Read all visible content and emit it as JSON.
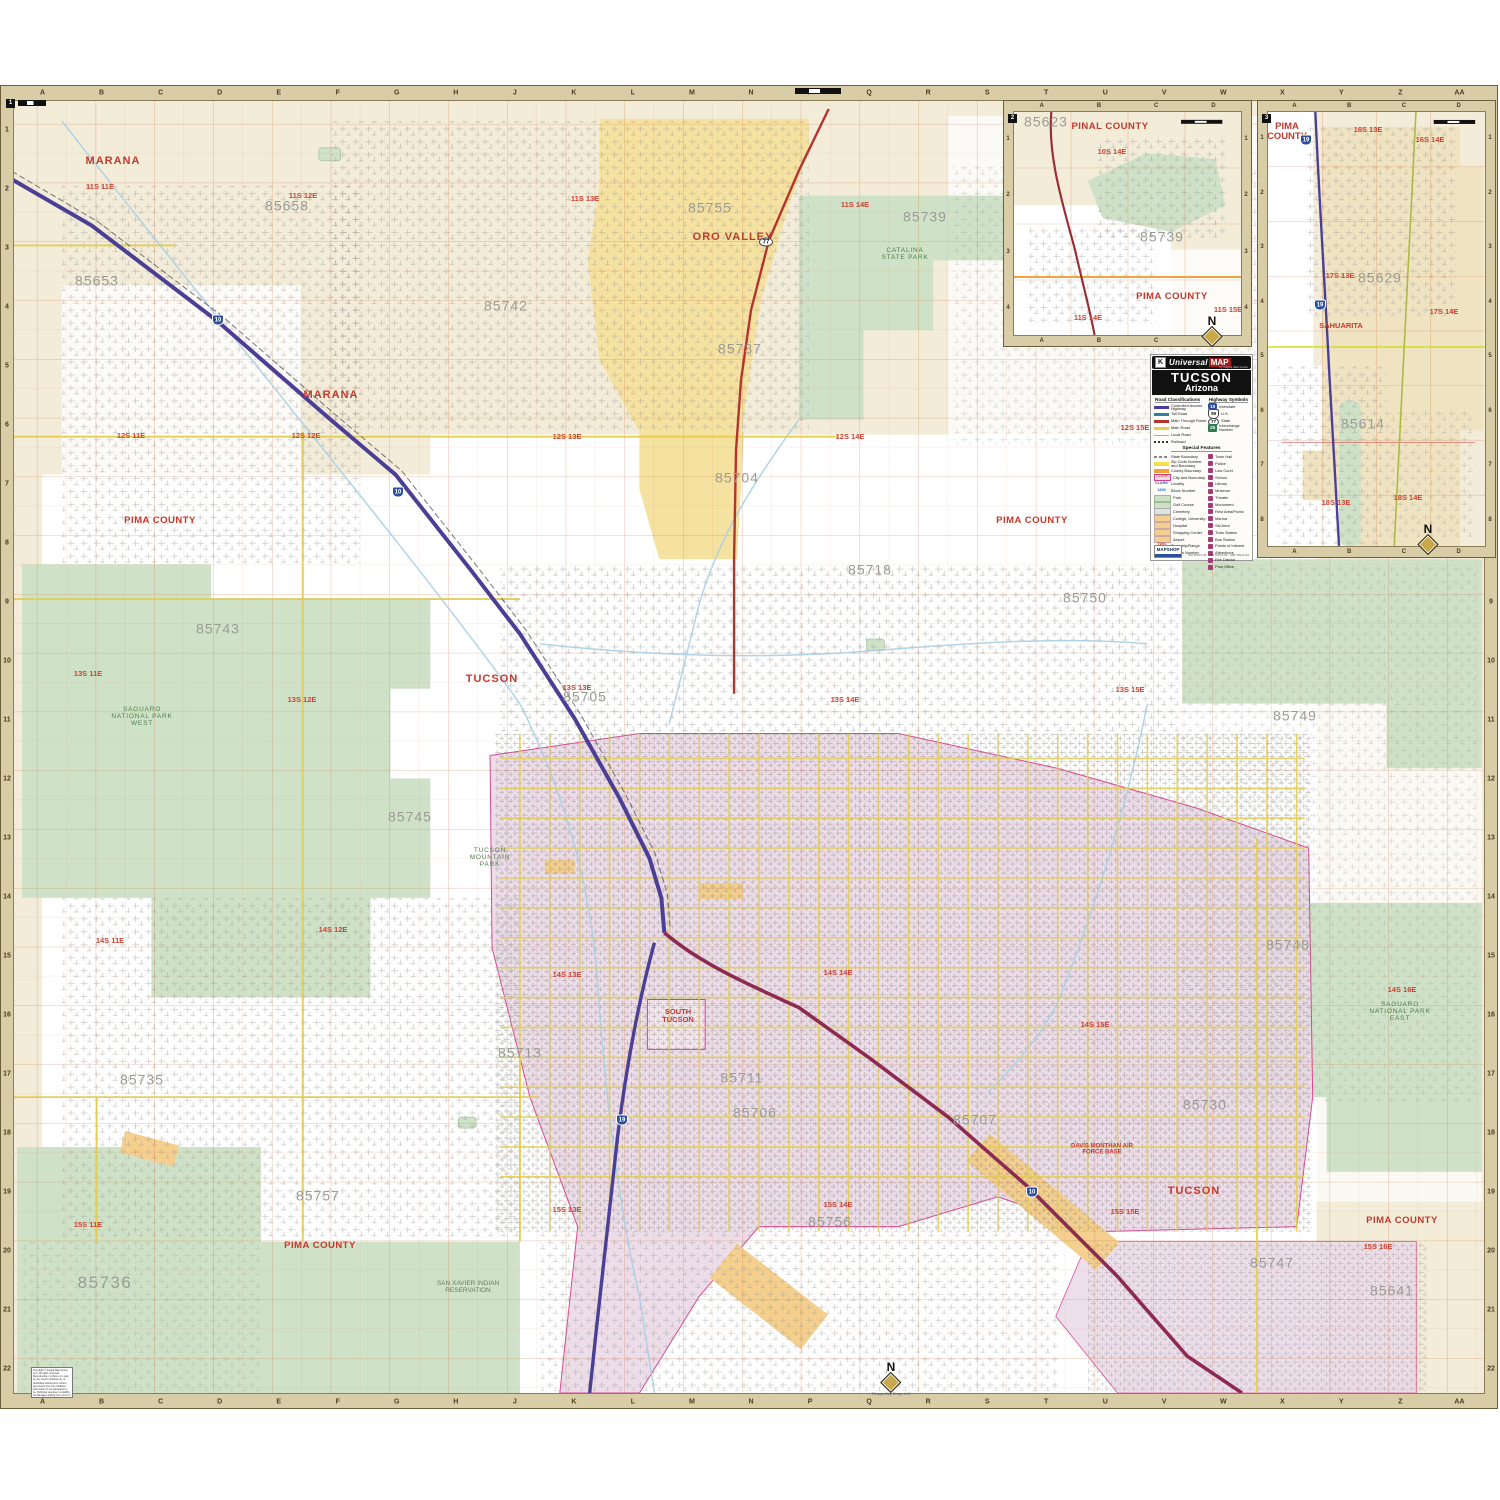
{
  "palette": {
    "cream": "#f2ecd9",
    "green": "#cfe2c8",
    "yellow_area": "#f5e1a0",
    "pink": "#ecdce8",
    "peach": "#f4cf8e",
    "border_tan": "#d8cda6",
    "grid_red": "#c65d2d",
    "road_yellow": "#e3cc52",
    "interstate": "#4a3f94",
    "main_route": "#b5332d",
    "water": "#a9cfe6",
    "label_red": "#c3392c",
    "label_gray": "#9b9b96"
  },
  "sheet": {
    "ref": "1"
  },
  "grid": {
    "columns": [
      "A",
      "B",
      "C",
      "D",
      "E",
      "F",
      "G",
      "H",
      "J",
      "K",
      "L",
      "M",
      "N",
      "P",
      "Q",
      "R",
      "S",
      "T",
      "U",
      "V",
      "W",
      "X",
      "Y",
      "Z",
      "AA"
    ],
    "rows": [
      "1",
      "2",
      "3",
      "4",
      "5",
      "6",
      "7",
      "8",
      "9",
      "10",
      "11",
      "12",
      "13",
      "14",
      "15",
      "16",
      "17",
      "18",
      "19",
      "20",
      "21",
      "22"
    ]
  },
  "map_labels": [
    {
      "t": "MARANA",
      "k": "city",
      "x": 113,
      "y": 162
    },
    {
      "t": "ORO VALLEY",
      "k": "city",
      "x": 733,
      "y": 238
    },
    {
      "t": "MARANA",
      "k": "city",
      "x": 331,
      "y": 396
    },
    {
      "t": "TUCSON",
      "k": "city",
      "x": 492,
      "y": 680
    },
    {
      "t": "TUCSON",
      "k": "city",
      "x": 1194,
      "y": 1192
    },
    {
      "t": "SOUTH TUCSON",
      "k": "citysm",
      "x": 678,
      "y": 1016,
      "w": 46
    },
    {
      "t": "PIMA COUNTY",
      "k": "county",
      "x": 160,
      "y": 521
    },
    {
      "t": "PIMA COUNTY",
      "k": "county",
      "x": 1032,
      "y": 521
    },
    {
      "t": "PIMA COUNTY",
      "k": "county",
      "x": 320,
      "y": 1246
    },
    {
      "t": "PIMA COUNTY",
      "k": "county",
      "x": 1402,
      "y": 1221
    },
    {
      "t": "11S 11E",
      "k": "twp",
      "x": 100,
      "y": 187
    },
    {
      "t": "11S 12E",
      "k": "twp",
      "x": 303,
      "y": 196
    },
    {
      "t": "11S 13E",
      "k": "twp",
      "x": 585,
      "y": 199
    },
    {
      "t": "11S 14E",
      "k": "twp",
      "x": 855,
      "y": 205
    },
    {
      "t": "12S 11E",
      "k": "twp",
      "x": 131,
      "y": 436
    },
    {
      "t": "12S 12E",
      "k": "twp",
      "x": 306,
      "y": 436
    },
    {
      "t": "12S 13E",
      "k": "twp",
      "x": 567,
      "y": 437
    },
    {
      "t": "12S 14E",
      "k": "twp",
      "x": 850,
      "y": 437
    },
    {
      "t": "12S 15E",
      "k": "twp",
      "x": 1135,
      "y": 428
    },
    {
      "t": "13S 11E",
      "k": "twp",
      "x": 88,
      "y": 674
    },
    {
      "t": "13S 12E",
      "k": "twp",
      "x": 302,
      "y": 700
    },
    {
      "t": "13S 13E",
      "k": "twp",
      "x": 577,
      "y": 688
    },
    {
      "t": "13S 14E",
      "k": "twp",
      "x": 845,
      "y": 700
    },
    {
      "t": "13S 15E",
      "k": "twp",
      "x": 1130,
      "y": 690
    },
    {
      "t": "14S 11E",
      "k": "twp",
      "x": 110,
      "y": 941
    },
    {
      "t": "14S 12E",
      "k": "twp",
      "x": 333,
      "y": 930
    },
    {
      "t": "14S 13E",
      "k": "twp",
      "x": 567,
      "y": 975
    },
    {
      "t": "14S 14E",
      "k": "twp",
      "x": 838,
      "y": 973
    },
    {
      "t": "14S 15E",
      "k": "twp",
      "x": 1095,
      "y": 1025
    },
    {
      "t": "14S 16E",
      "k": "twp",
      "x": 1402,
      "y": 990
    },
    {
      "t": "15S 11E",
      "k": "twp",
      "x": 88,
      "y": 1225
    },
    {
      "t": "15S 13E",
      "k": "twp",
      "x": 567,
      "y": 1210
    },
    {
      "t": "15S 14E",
      "k": "twp",
      "x": 838,
      "y": 1205
    },
    {
      "t": "15S 15E",
      "k": "twp",
      "x": 1125,
      "y": 1212
    },
    {
      "t": "15S 16E",
      "k": "twp",
      "x": 1378,
      "y": 1247
    },
    {
      "t": "85658",
      "k": "zip",
      "x": 287,
      "y": 206
    },
    {
      "t": "85653",
      "k": "zip",
      "x": 97,
      "y": 281
    },
    {
      "t": "85755",
      "k": "zip",
      "x": 710,
      "y": 208
    },
    {
      "t": "85739",
      "k": "zip",
      "x": 925,
      "y": 217
    },
    {
      "t": "85742",
      "k": "zip",
      "x": 506,
      "y": 306
    },
    {
      "t": "85737",
      "k": "zip",
      "x": 740,
      "y": 349
    },
    {
      "t": "85704",
      "k": "zip",
      "x": 737,
      "y": 478
    },
    {
      "t": "85718",
      "k": "zip",
      "x": 870,
      "y": 570
    },
    {
      "t": "85750",
      "k": "zip",
      "x": 1085,
      "y": 598
    },
    {
      "t": "85743",
      "k": "zip",
      "x": 218,
      "y": 629
    },
    {
      "t": "85705",
      "k": "zip",
      "x": 585,
      "y": 697
    },
    {
      "t": "85749",
      "k": "zip",
      "x": 1295,
      "y": 716
    },
    {
      "t": "85745",
      "k": "zip",
      "x": 410,
      "y": 817
    },
    {
      "t": "85748",
      "k": "zip",
      "x": 1288,
      "y": 945
    },
    {
      "t": "85735",
      "k": "zip",
      "x": 142,
      "y": 1080
    },
    {
      "t": "85713",
      "k": "zip",
      "x": 520,
      "y": 1053
    },
    {
      "t": "85711",
      "k": "zip",
      "x": 742,
      "y": 1078
    },
    {
      "t": "85730",
      "k": "zip",
      "x": 1205,
      "y": 1105
    },
    {
      "t": "85706",
      "k": "zip",
      "x": 755,
      "y": 1113
    },
    {
      "t": "85707",
      "k": "zip",
      "x": 975,
      "y": 1120
    },
    {
      "t": "85757",
      "k": "zip",
      "x": 318,
      "y": 1196
    },
    {
      "t": "85756",
      "k": "zip",
      "x": 830,
      "y": 1222
    },
    {
      "t": "85747",
      "k": "zip",
      "x": 1272,
      "y": 1263
    },
    {
      "t": "85641",
      "k": "zip",
      "x": 1392,
      "y": 1291
    },
    {
      "t": "85736",
      "k": "zipxl",
      "x": 105,
      "y": 1283
    },
    {
      "t": "Catalina State Park",
      "k": "park",
      "x": 905,
      "y": 255,
      "w": 60
    },
    {
      "t": "Saguaro National Park West",
      "k": "park",
      "x": 142,
      "y": 717,
      "w": 70
    },
    {
      "t": "Tucson Mountain Park",
      "k": "park",
      "x": 490,
      "y": 858,
      "w": 60
    },
    {
      "t": "Saguaro National Park East",
      "k": "park",
      "x": 1400,
      "y": 1012,
      "w": 66
    },
    {
      "t": "San Xavier Indian Reservation",
      "k": "resv",
      "x": 468,
      "y": 1288,
      "w": 80
    },
    {
      "t": "Davis Monthan Air Force Base",
      "k": "poi",
      "x": 1102,
      "y": 1150,
      "w": 70
    }
  ],
  "insets": [
    {
      "ref": "2",
      "columns": [
        "A",
        "B",
        "C",
        "D"
      ],
      "rows": [
        "1",
        "2",
        "3",
        "4"
      ],
      "labels": [
        {
          "t": "85623",
          "k": "zip",
          "x": 1046,
          "y": 122
        },
        {
          "t": "PINAL COUNTY",
          "k": "county",
          "x": 1110,
          "y": 127
        },
        {
          "t": "10S 14E",
          "k": "twp",
          "x": 1112,
          "y": 152
        },
        {
          "t": "85739",
          "k": "zip",
          "x": 1162,
          "y": 237
        },
        {
          "t": "PIMA COUNTY",
          "k": "county",
          "x": 1172,
          "y": 297
        },
        {
          "t": "11S 14E",
          "k": "twp",
          "x": 1088,
          "y": 318
        },
        {
          "t": "11S 15E",
          "k": "twp",
          "x": 1228,
          "y": 310
        }
      ]
    },
    {
      "ref": "3",
      "columns": [
        "A",
        "B",
        "C",
        "D"
      ],
      "rows": [
        "1",
        "2",
        "3",
        "4",
        "5",
        "6",
        "7",
        "8"
      ],
      "labels": [
        {
          "t": "PIMA COUNTY",
          "k": "countywrap",
          "x": 1287,
          "y": 132,
          "w": 50
        },
        {
          "t": "16S 13E",
          "k": "twp",
          "x": 1368,
          "y": 130
        },
        {
          "t": "16S 14E",
          "k": "twp",
          "x": 1430,
          "y": 140
        },
        {
          "t": "17S 13E",
          "k": "twp",
          "x": 1340,
          "y": 276
        },
        {
          "t": "85629",
          "k": "zip",
          "x": 1380,
          "y": 278
        },
        {
          "t": "17S 14E",
          "k": "twp",
          "x": 1444,
          "y": 312
        },
        {
          "t": "SAHUARITA",
          "k": "citysm",
          "x": 1341,
          "y": 326,
          "w": 60
        },
        {
          "t": "85614",
          "k": "zip",
          "x": 1363,
          "y": 424
        },
        {
          "t": "18S 13E",
          "k": "twp",
          "x": 1336,
          "y": 503
        },
        {
          "t": "18S 14E",
          "k": "twp",
          "x": 1408,
          "y": 498
        }
      ]
    }
  ],
  "shields": [
    {
      "n": "10",
      "x": 218,
      "y": 320
    },
    {
      "n": "10",
      "x": 398,
      "y": 492
    },
    {
      "n": "10",
      "x": 1032,
      "y": 1192
    },
    {
      "n": "19",
      "x": 622,
      "y": 1120
    },
    {
      "n": "19",
      "x": 1306,
      "y": 140
    },
    {
      "n": "19",
      "x": 1320,
      "y": 305
    },
    {
      "n": "77",
      "x": 766,
      "y": 242,
      "t": "oval"
    }
  ],
  "compasses": [
    {
      "x": 891,
      "y": 1362,
      "credit": true
    },
    {
      "x": 1212,
      "y": 316
    },
    {
      "x": 1428,
      "y": 524
    }
  ],
  "compass_letter": "N",
  "compass_credit": "©Kappa Map Group, LLC",
  "legend": {
    "brand": {
      "k": "K",
      "name1": "Universal",
      "name2": "MAP",
      "tagline": "by Kappa Map Group"
    },
    "title": "TUCSON",
    "subtitle": "Arizona",
    "sec_roads": "Road Classifications",
    "sec_hwy": "Highway Symbols",
    "sec_special": "Special Features",
    "road_classes": [
      {
        "label": "Controlled Access Highway",
        "s": "cah"
      },
      {
        "label": "Toll Road",
        "s": "toll"
      },
      {
        "label": "Main Through Route",
        "s": "mtr"
      },
      {
        "label": "Main Road",
        "s": "mainrd"
      },
      {
        "label": "Local Road",
        "s": "local"
      },
      {
        "label": "Railroad",
        "s": "rail"
      }
    ],
    "highway_symbols": [
      {
        "label": "Interstate",
        "s": "int",
        "n": "10"
      },
      {
        "label": "U.S.",
        "s": "us",
        "n": "89"
      },
      {
        "label": "State",
        "s": "st",
        "n": "77"
      },
      {
        "label": "Interchange Number",
        "s": "inum",
        "n": "25"
      }
    ],
    "features_left": [
      {
        "label": "State Boundary",
        "s": "stateb"
      },
      {
        "label": "Zip Code Number and Boundary",
        "s": "zipb"
      },
      {
        "label": "County Boundary",
        "s": "countyb"
      },
      {
        "label": "City and Boundary",
        "s": "cityb",
        "sample": "CLARK"
      },
      {
        "label": "Locality",
        "s": "loc",
        "sample": "CLARK"
      },
      {
        "label": "Block Number",
        "s": "blk",
        "sample": "1200"
      },
      {
        "label": "Park",
        "s": "park"
      },
      {
        "label": "Golf Course",
        "s": "golf"
      },
      {
        "label": "Cemetery",
        "s": "cem"
      },
      {
        "label": "College, University",
        "s": "col"
      },
      {
        "label": "Hospital",
        "s": "hosp"
      },
      {
        "label": "Shopping Center",
        "s": "shop"
      },
      {
        "label": "Airport",
        "s": "air"
      },
      {
        "label": "Township/Range",
        "s": "twnrge",
        "sample": "TWN RGE"
      },
      {
        "label": "Section Number",
        "s": "secnum",
        "sample": "6"
      }
    ],
    "features_right": [
      "Town Hall",
      "Police",
      "Law Court",
      "School",
      "Library",
      "Museum",
      "Theater",
      "Monument",
      "Rest Area/Picnic",
      "Marina",
      "Ski Area",
      "Train Station",
      "Bus Station",
      "Points of Interest",
      "Attractions",
      "Fire District",
      "Post Office"
    ],
    "mapshop": "MAPSHOP",
    "codes": "UM 10277-02 · MM 70272-02 · MW 78212-02"
  },
  "copyright": {
    "text": "Copyright © Kappa Map Group, LLC. All rights reserved. Reproduction in whole or in part, by any means whatsoever, is prohibited without prior written permission from the publisher. Information is not warranted by us. Publisher assumes no liability for damages arising from errors or omissions.",
    "url": "www.kappamapgroup.com"
  }
}
